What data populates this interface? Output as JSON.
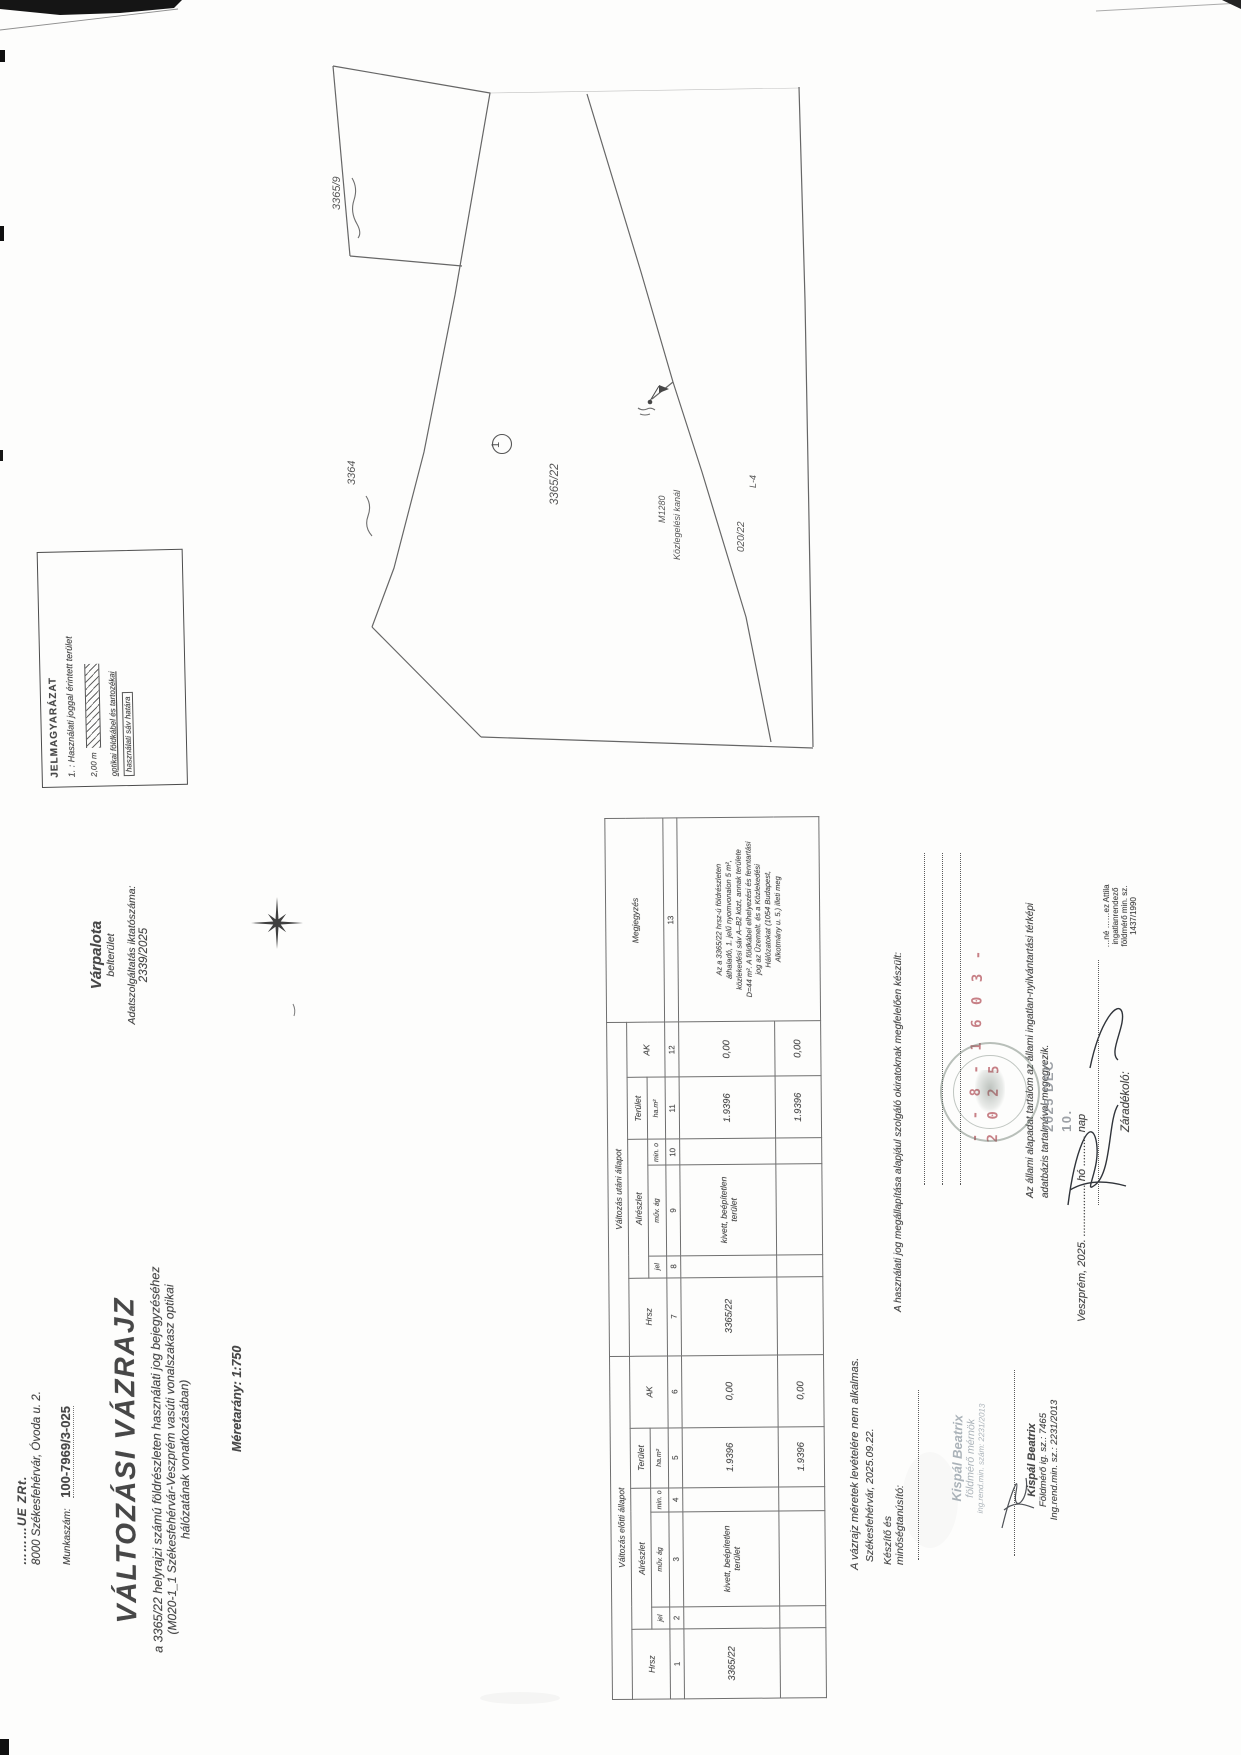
{
  "company": {
    "name": "………UE ZRt.",
    "address": "8000 Székesfehérvár, Óvoda u. 2.",
    "worknum_label": "Munkaszám:",
    "worknum": "100-7969/3-025"
  },
  "place": {
    "city": "Várpalota",
    "area": "belterület",
    "data_label": "Adatszolgáltatás iktatószáma:",
    "data_number": "2339/2025"
  },
  "title": {
    "main": "VÁLTOZÁSI VÁZRAJZ",
    "sub1": "a 3365/22 helyrajzi számú földrészleten használati jog bejegyzéséhez",
    "sub2": "(M020-1_1 Székesfehérvár-Veszprém vasúti vonalszakasz optikai",
    "sub3": "hálózatának vonatkozásában)",
    "scale": "Méretarány: 1:750"
  },
  "legend": {
    "title": "JELMAGYARÁZAT",
    "item1": "1. : Használati joggal érintett terület",
    "measure": "2,00 m",
    "label1": "optikai földkábel és tartozékai",
    "label2": "használati sáv határa"
  },
  "map": {
    "labels": {
      "p3365_9": "3365/9",
      "p3364": "3364",
      "p3365_22": "3365/22",
      "circle1": "1",
      "m1280": "M1280",
      "kanal": "Közlegelési kanál",
      "p020_22": "020/22",
      "l4": "L-4"
    }
  },
  "table": {
    "section_before": "Változás előtti állapot",
    "section_after": "Változás utáni állapot",
    "col_hrsz": "Hrsz",
    "col_alreszlet": "Alrészlet",
    "col_terulet": "Terület",
    "col_ak": "AK",
    "col_megjegyzes": "Megjegyzés",
    "sub_jel": "jel",
    "sub_muvag": "műv. ág",
    "sub_mino": "min. o",
    "sub_ham2": "ha.m²",
    "numbers": [
      "1",
      "2",
      "3",
      "4",
      "5",
      "6",
      "7",
      "8",
      "9",
      "10",
      "11",
      "12",
      "13"
    ],
    "row": {
      "hrsz_before": "3365/22",
      "muvag_before": "kivett, beépítetlen terület",
      "terulet_before": "1.9396",
      "ak_before": "0,00",
      "hrsz_after": "3365/22",
      "muvag_after": "kivett, beépítetlen terület",
      "terulet_after": "1.9396",
      "ak_after": "0,00"
    },
    "totals": {
      "terulet_before": "1.9396",
      "ak_before": "0,00",
      "terulet_after": "1.9396",
      "ak_after": "0,00"
    },
    "megjegyzes_lines": [
      "Az a 3365/22 hrsz-ú földrészleten",
      "áthaladó, 1. jelű nyomvonalon 5 m²,",
      "közlekedési sáv A–B2 közt, annak területe",
      "D=44 m². A földkábel elhelyezési és fenntartási",
      "jog az Üzemelt. és a Közlekedési",
      "Hálózatokat (1054 Budapest,",
      "Alkotmány u. 5.) illeti meg"
    ]
  },
  "notes": {
    "map_note": "A vázrajz méretek levételére nem alkalmas."
  },
  "statements": {
    "s1": "A használati jog megállapítása alapjául szolgáló okiratoknak megfelelően készült:",
    "red_number": "- - 8 - 1 6 0 3 - 2 0 2 5",
    "s2a": "Az állami alapadat tartalom az állami ingatlan-nyilvántartási térképi",
    "s2b": "adatbázis tartalmával megegyezik.",
    "veszprem": "Veszprém, 2025. ................. hó .......... nap",
    "date_stamp": "2025 DEC 10.",
    "zaradekolo": "Záradékoló:",
    "clerk": [
      "…né ……ez Attila",
      "ingatlanrendező",
      "földmérő min. sz.",
      "1437/1990"
    ]
  },
  "signer": {
    "city_date": "Székesfehérvár, 2025.09.22.",
    "keszito1": "Készítő és",
    "keszito2": "minőségtanúsító:",
    "stamp": [
      "Kispál Beatrix",
      "földmérő mérnök",
      "ing.rend.min. szám: 2231/2013"
    ],
    "printed": [
      "Kispál Beatrix",
      "Földmérő ig. sz.: 7465",
      "Ing.rend.min. sz.: 2231/2013"
    ]
  }
}
